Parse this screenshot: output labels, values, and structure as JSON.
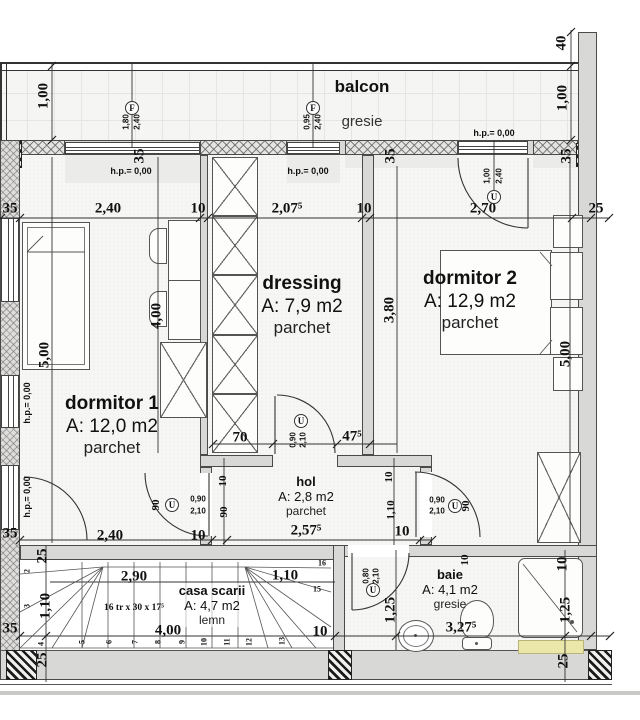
{
  "rooms": {
    "balcon": {
      "name": "balcon",
      "floor": "gresie"
    },
    "dormitor1": {
      "name": "dormitor 1",
      "area": "A: 12,0 m2",
      "floor": "parchet"
    },
    "dressing": {
      "name": "dressing",
      "area": "A: 7,9 m2",
      "floor": "parchet"
    },
    "dormitor2": {
      "name": "dormitor 2",
      "area": "A: 12,9 m2",
      "floor": "parchet"
    },
    "hol": {
      "name": "hol",
      "area": "A: 2,8 m2",
      "floor": "parchet"
    },
    "casa_scarii": {
      "name": "casa scarii",
      "area": "A: 4,7 m2",
      "floor": "lemn",
      "stair_note": "16 tr x 30 x 17⁵"
    },
    "baie": {
      "name": "baie",
      "area": "A: 4,1 m2",
      "floor": "gresie"
    }
  },
  "colors": {
    "wall": "#d8d8d6",
    "accent_yellow": "#eae7a8",
    "line": "#333333"
  },
  "markers": [
    {
      "s": "F",
      "x": 132,
      "y": 108
    },
    {
      "s": "F",
      "x": 313,
      "y": 108
    },
    {
      "s": "U",
      "x": 494,
      "y": 197
    },
    {
      "s": "U",
      "x": 172,
      "y": 505
    },
    {
      "s": "U",
      "x": 301,
      "y": 421
    },
    {
      "s": "U",
      "x": 455,
      "y": 506
    },
    {
      "s": "U",
      "x": 373,
      "y": 590
    }
  ],
  "labels": [
    {
      "t": "35",
      "x": 10,
      "y": 209
    },
    {
      "t": "2,40",
      "x": 108,
      "y": 209
    },
    {
      "t": "10",
      "x": 198,
      "y": 209
    },
    {
      "t": "2,07⁵",
      "x": 287,
      "y": 209
    },
    {
      "t": "10",
      "x": 364,
      "y": 209
    },
    {
      "t": "2,70",
      "x": 483,
      "y": 209
    },
    {
      "t": "25",
      "x": 596,
      "y": 209
    },
    {
      "t": "1,00",
      "x": 44,
      "y": 96,
      "c": "r"
    },
    {
      "t": "40",
      "x": 562,
      "y": 43,
      "c": "r"
    },
    {
      "t": "1,00",
      "x": 563,
      "y": 98,
      "c": "r"
    },
    {
      "t": "35",
      "x": 140,
      "y": 156,
      "c": "r"
    },
    {
      "t": "35",
      "x": 391,
      "y": 156,
      "c": "r"
    },
    {
      "t": "35",
      "x": 567,
      "y": 156,
      "c": "r"
    },
    {
      "t": "5,00",
      "x": 45,
      "y": 355,
      "c": "r"
    },
    {
      "t": "4,00",
      "x": 157,
      "y": 316,
      "c": "r"
    },
    {
      "t": "3,80",
      "x": 390,
      "y": 310,
      "c": "r"
    },
    {
      "t": "5,00",
      "x": 566,
      "y": 354,
      "c": "r"
    },
    {
      "t": "h.p.= 0,00",
      "x": 131,
      "y": 171,
      "c": "hp"
    },
    {
      "t": "h.p.= 0,00",
      "x": 308,
      "y": 171,
      "c": "hp"
    },
    {
      "t": "h.p.= 0,00",
      "x": 494,
      "y": 133,
      "c": "hp"
    },
    {
      "t": "h.p.= 0,00",
      "x": 27,
      "y": 403,
      "c": "hp r"
    },
    {
      "t": "h.p.= 0,00",
      "x": 27,
      "y": 497,
      "c": "hp r"
    },
    {
      "t": "1,80",
      "x": 126,
      "y": 122,
      "c": "xs r"
    },
    {
      "t": "2,40",
      "x": 137,
      "y": 122,
      "c": "xs r"
    },
    {
      "t": "0,95",
      "x": 307,
      "y": 122,
      "c": "xs r"
    },
    {
      "t": "2,40",
      "x": 318,
      "y": 122,
      "c": "xs r"
    },
    {
      "t": "1,00",
      "x": 487,
      "y": 176,
      "c": "xs r"
    },
    {
      "t": "2,40",
      "x": 499,
      "y": 176,
      "c": "xs r"
    },
    {
      "t": "70",
      "x": 240,
      "y": 438
    },
    {
      "t": "47⁵",
      "x": 352,
      "y": 437
    },
    {
      "t": "10",
      "x": 223,
      "y": 481,
      "c": "sm r"
    },
    {
      "t": "90",
      "x": 224,
      "y": 512,
      "c": "sm r"
    },
    {
      "t": "90",
      "x": 156,
      "y": 505,
      "c": "sm r"
    },
    {
      "t": "0,90",
      "x": 198,
      "y": 499,
      "c": "xs"
    },
    {
      "t": "2,10",
      "x": 198,
      "y": 511,
      "c": "xs"
    },
    {
      "t": "0,90",
      "x": 293,
      "y": 440,
      "c": "xs r"
    },
    {
      "t": "2,10",
      "x": 303,
      "y": 440,
      "c": "xs r"
    },
    {
      "t": "0,90",
      "x": 437,
      "y": 500,
      "c": "xs"
    },
    {
      "t": "2,10",
      "x": 437,
      "y": 511,
      "c": "xs"
    },
    {
      "t": "90",
      "x": 466,
      "y": 506,
      "c": "sm r"
    },
    {
      "t": "10",
      "x": 389,
      "y": 477,
      "c": "sm r"
    },
    {
      "t": "1,10",
      "x": 391,
      "y": 510,
      "c": "sm r"
    },
    {
      "t": "10",
      "x": 402,
      "y": 532
    },
    {
      "t": "2,40",
      "x": 110,
      "y": 536
    },
    {
      "t": "10",
      "x": 198,
      "y": 536
    },
    {
      "t": "2,57⁵",
      "x": 306,
      "y": 531
    },
    {
      "t": "25",
      "x": 43,
      "y": 556,
      "c": "r"
    },
    {
      "t": "2",
      "x": 27,
      "y": 571,
      "c": "tread r"
    },
    {
      "t": "3",
      "x": 27,
      "y": 606,
      "c": "tread r"
    },
    {
      "t": "1,10",
      "x": 46,
      "y": 606,
      "c": "r"
    },
    {
      "t": "35",
      "x": 10,
      "y": 534
    },
    {
      "t": "35",
      "x": 10,
      "y": 629
    },
    {
      "t": "2,90",
      "x": 134,
      "y": 577
    },
    {
      "t": "1,10",
      "x": 285,
      "y": 576
    },
    {
      "t": "16",
      "x": 322,
      "y": 563,
      "c": "tread"
    },
    {
      "t": "15",
      "x": 317,
      "y": 589,
      "c": "tread"
    },
    {
      "t": "4",
      "x": 41,
      "y": 644,
      "c": "tread r"
    },
    {
      "t": "5",
      "x": 82,
      "y": 642,
      "c": "tread r"
    },
    {
      "t": "6",
      "x": 109,
      "y": 642,
      "c": "tread r"
    },
    {
      "t": "7",
      "x": 135,
      "y": 642,
      "c": "tread r"
    },
    {
      "t": "8",
      "x": 158,
      "y": 642,
      "c": "tread r"
    },
    {
      "t": "9",
      "x": 182,
      "y": 642,
      "c": "tread r"
    },
    {
      "t": "10",
      "x": 204,
      "y": 642,
      "c": "tread r"
    },
    {
      "t": "11",
      "x": 227,
      "y": 642,
      "c": "tread r"
    },
    {
      "t": "12",
      "x": 249,
      "y": 642,
      "c": "tread r"
    },
    {
      "t": "13",
      "x": 282,
      "y": 641,
      "c": "tread r"
    },
    {
      "t": "4,00",
      "x": 168,
      "y": 631
    },
    {
      "t": "10",
      "x": 320,
      "y": 632
    },
    {
      "t": "3,27⁵",
      "x": 461,
      "y": 628
    },
    {
      "t": "25",
      "x": 43,
      "y": 660,
      "c": "r"
    },
    {
      "t": "25",
      "x": 564,
      "y": 661,
      "c": "r"
    },
    {
      "t": "0,80",
      "x": 366,
      "y": 576,
      "c": "xs r"
    },
    {
      "t": "2,10",
      "x": 376,
      "y": 576,
      "c": "xs r"
    },
    {
      "t": "1,25",
      "x": 391,
      "y": 610,
      "c": "r"
    },
    {
      "t": "10",
      "x": 563,
      "y": 564,
      "c": "r"
    },
    {
      "t": "1,25",
      "x": 566,
      "y": 610,
      "c": "r"
    },
    {
      "t": "10",
      "x": 465,
      "y": 560,
      "c": "sm r"
    }
  ]
}
